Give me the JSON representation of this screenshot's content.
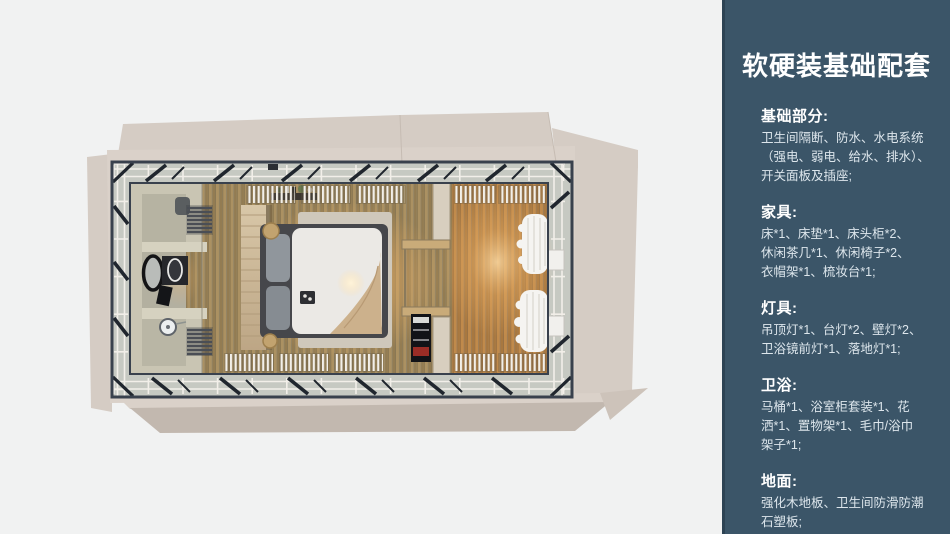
{
  "palette": {
    "canvas": "#f1f2f2",
    "sidebar-bg": "#3b5568",
    "sidebar-edge": "#2d4354",
    "sidebar-title": "#ffffff",
    "sidebar-body": "#dde6ec",
    "deck": "#dad1c9",
    "deck-flap": "#d5ccc4",
    "deck-shadow": "#c2b8af",
    "frame": "#39414d",
    "glass": "#c6c9c2",
    "rail": "#f2efe9",
    "brace": "#20262e",
    "tile": "#c9c5b3",
    "curtain": "#f5f4f1"
  },
  "sidebar": {
    "title": "软硬装基础配套",
    "sections": [
      {
        "heading": "基础部分:",
        "body": "卫生间隔断、防水、水电系统\n（强电、弱电、给水、排水）、\n开关面板及插座;"
      },
      {
        "heading": "家具:",
        "body": "床*1、床垫*1、床头柜*2、\n休闲茶几*1、休闲椅子*2、\n衣帽架*1、梳妆台*1;"
      },
      {
        "heading": "灯具:",
        "body": "吊顶灯*1、台灯*2、壁灯*2、\n卫浴镜前灯*1、落地灯*1;"
      },
      {
        "heading": "卫浴:",
        "body": "马桶*1、浴室柜套装*1、花\n洒*1、置物架*1、毛巾/浴巾\n架子*1;"
      },
      {
        "heading": "地面:",
        "body": "强化木地板、卫生间防滑防潮\n石塑板;"
      }
    ]
  }
}
